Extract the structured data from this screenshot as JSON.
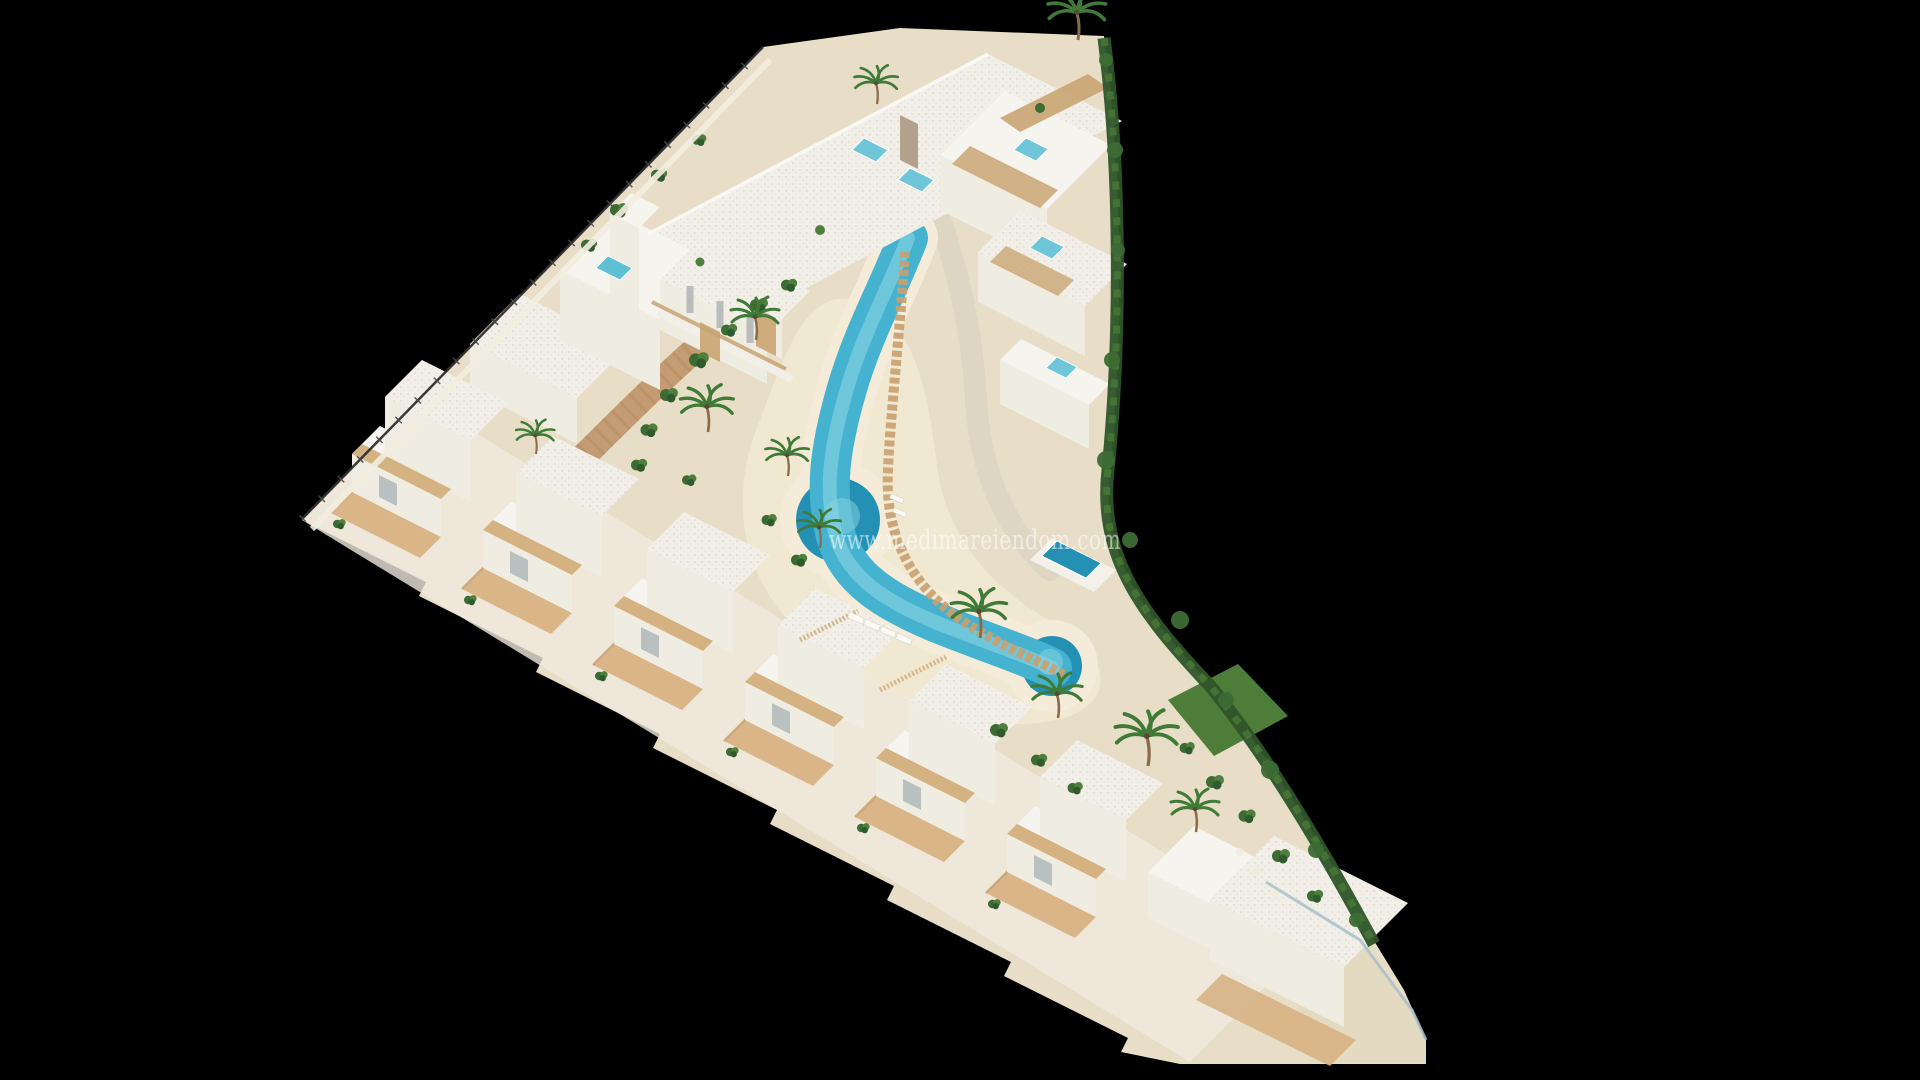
{
  "image": {
    "kind": "3d-aerial-architectural-render",
    "subject": "Triangular coastal residential development with winding lagoon pool, apartment blocks and a diagonal row of white villas on a black background"
  },
  "watermark": {
    "text": "www.medimareiendom.com"
  },
  "palette": {
    "background": "#000000",
    "sand": "#e8ddc6",
    "beach_sand": "#f1e8d3",
    "pool_edge_sand": "#f4ecd9",
    "pool": "#45b2cf",
    "pool_deep": "#2490b4",
    "pool_highlight": "#8ad6e2",
    "wall_white": "#f6f4ee",
    "wall_front": "#efece2",
    "wall_shade": "#d9d4c8",
    "roof_light": "#f1efe8",
    "wood": "#c9a472",
    "terrace": "#d7b284",
    "paving": "#c0956a",
    "hedge": "#2e5429",
    "shrub_dark": "#3c6b34",
    "shrub_light": "#4f7f3d",
    "grass": "#4e7d3a",
    "palm_green": "#3f7a37",
    "fence_dark": "#2f2f2f",
    "glass_fence": "#a8c0ca",
    "jacuzzi_blue": "#6fc6d8"
  },
  "scene_elements": [
    {
      "name": "apartment-block",
      "label": "Apartment block with rooftop terraces and jacuzzis"
    },
    {
      "name": "ibiza-cluster",
      "label": "Ibiza-style apartment cluster with tower"
    },
    {
      "name": "terraced-apartments",
      "label": "Terraced apartments with plunge pools"
    },
    {
      "name": "villa-row",
      "label": "Diagonal row of townhouse villas with private terraces"
    },
    {
      "name": "corner-villa",
      "label": "Corner villa with private garden"
    },
    {
      "name": "lagoon-pool",
      "label": "Winding turquoise lagoon swimming pool"
    },
    {
      "name": "beach-sand",
      "label": "Sand beach with sun loungers"
    },
    {
      "name": "vegetation",
      "label": "Palm trees, shrubs, lawn and perimeter hedge"
    },
    {
      "name": "perimeter-fence",
      "label": "Perimeter fence along site boundary"
    }
  ]
}
